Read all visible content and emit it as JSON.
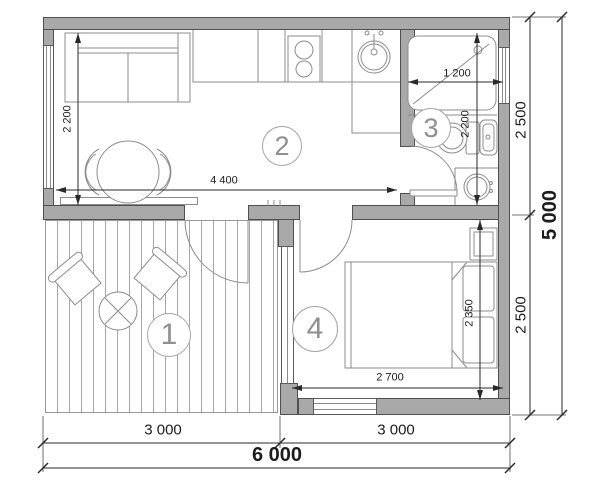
{
  "title": "floor-plan",
  "rooms": {
    "terrace": "1",
    "living_kitchen": "2",
    "bathroom": "3",
    "bedroom": "4"
  },
  "dimensions": {
    "overall_width": "6 000",
    "overall_depth": "5 000",
    "bottom_left_width": "3 000",
    "bottom_right_width": "3 000",
    "right_top_depth": "2 500",
    "right_bottom_depth": "2 500",
    "living_width": "4 400",
    "living_depth": "2 200",
    "bath_width": "1 200",
    "bath_depth": "2 200",
    "bedroom_width": "2 700",
    "bedroom_depth": "2 350"
  },
  "colors": {
    "wall": "#a9a9a9",
    "wall_border": "#4f4f4f",
    "furniture_line": "#8c8c8c",
    "dim_line": "#2a2a2a",
    "dim_text": "#1c1c1c",
    "label": "#8f8f8f",
    "deck_line": "#a6a6a6"
  }
}
